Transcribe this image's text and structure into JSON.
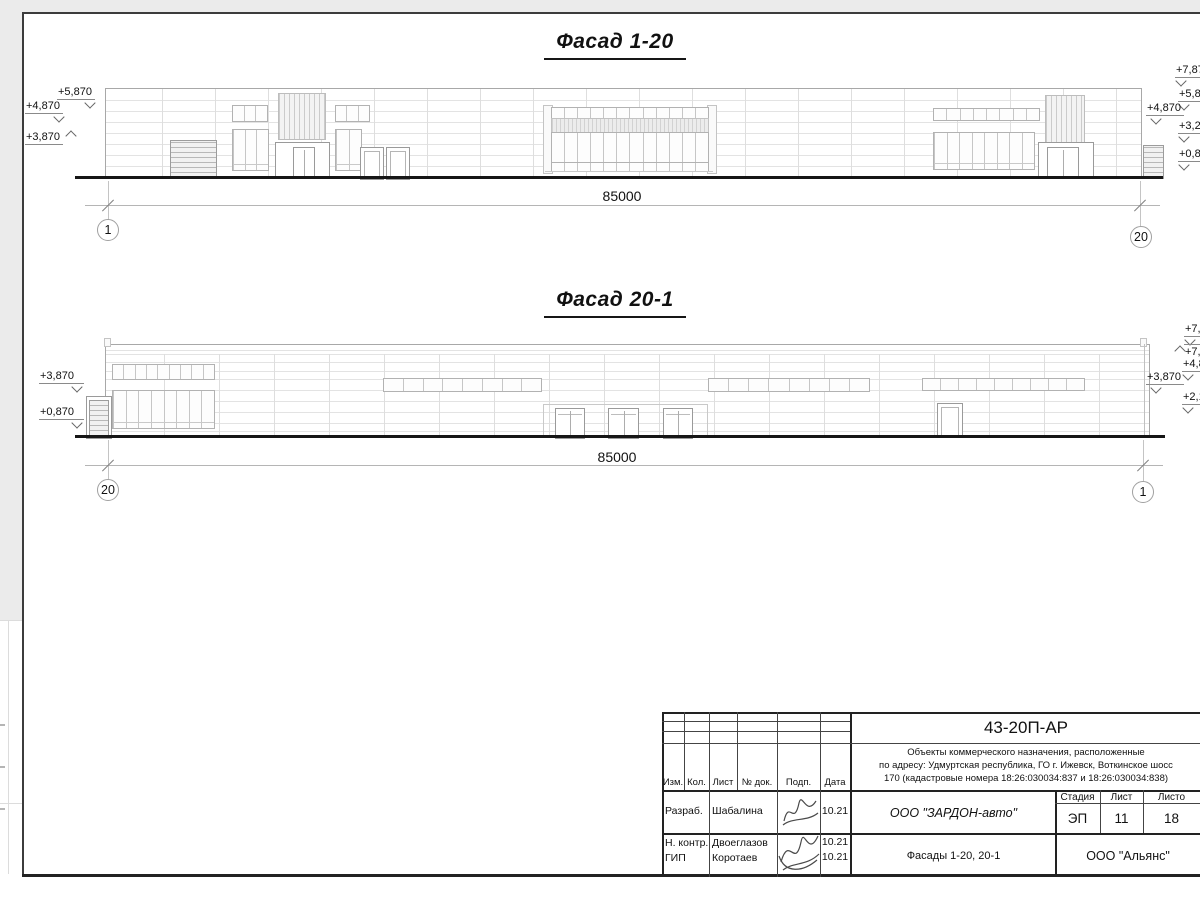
{
  "drawing": {
    "facade1": {
      "title": "Фасад 1-20",
      "dim": "85000",
      "axis_left": "1",
      "axis_right": "20",
      "marks_left": [
        "+5,870",
        "+4,870",
        "+3,870"
      ],
      "marks_right": [
        "+7,87",
        "+5,87",
        "+4,870",
        "+3,27",
        "+0,87"
      ]
    },
    "facade2": {
      "title": "Фасад 20-1",
      "dim": "85000",
      "axis_left": "20",
      "axis_right": "1",
      "marks_left": [
        "+3,870",
        "+0,870"
      ],
      "marks_right": [
        "+7,8",
        "+7,",
        "+4,8",
        "+3,870",
        "+2,1"
      ]
    },
    "stamp": {
      "code": "43-20П-АР",
      "desc1": "Объекты коммерческого назначения, расположенные",
      "desc2": "по адресу: Удмуртская республика, ГО г. Ижевск, Воткинское шосс",
      "desc3": "170 (кадастровые номера 18:26:030034:837 и 18:26:030034:838)",
      "h_izm": "Изм.",
      "h_kol": "Кол.",
      "h_list": "Лист",
      "h_doc": "№ док.",
      "h_podp": "Подп.",
      "h_data": "Дата",
      "r1_role": "Разраб.",
      "r1_name": "Шабалина",
      "r1_date": "10.21",
      "r2_role": "Н. контр.",
      "r2_name": "Двоеглазов",
      "r2_date": "10.21",
      "r3_role": "ГИП",
      "r3_name": "Коротаев",
      "r3_date": "10.21",
      "company": "ООО \"ЗАРДОН-авто\"",
      "sheet_name": "Фасады 1-20, 20-1",
      "stage_h": "Стадия",
      "list_h": "Лист",
      "listov_h": "Листо",
      "stage": "ЭП",
      "list": "11",
      "listov": "18",
      "org": "ООО \"Альянс\""
    }
  }
}
